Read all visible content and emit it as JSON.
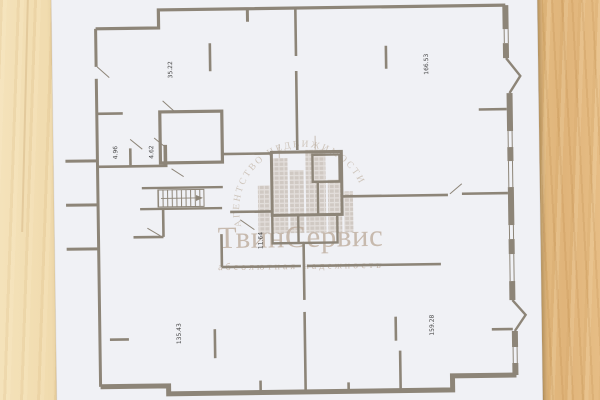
{
  "watermark": {
    "arc_text": "АГЕНТСТВО НЕДВИЖИМОСТИ",
    "brand": "ТвинСервис",
    "tagline": "абсолютная надежность",
    "color": "#bfae9f"
  },
  "floor_plan": {
    "room_labels": [
      {
        "name": "top-left-room-area",
        "value": "35.22"
      },
      {
        "name": "top-right-room-area",
        "value": "166.53"
      },
      {
        "name": "left-small-room-1-area",
        "value": "4.96"
      },
      {
        "name": "left-small-room-2-area",
        "value": "4.62"
      },
      {
        "name": "center-hall-area",
        "value": "11.64"
      },
      {
        "name": "bottom-left-room-area",
        "value": "135.43"
      },
      {
        "name": "bottom-right-room-area",
        "value": "159.28"
      }
    ],
    "wall_color": "#8d8578",
    "paper_color": "#f0f1f5",
    "label_color": "#454545"
  },
  "background": {
    "wood_light": "#f3e0b6",
    "wood_dark": "#e2b87e"
  }
}
